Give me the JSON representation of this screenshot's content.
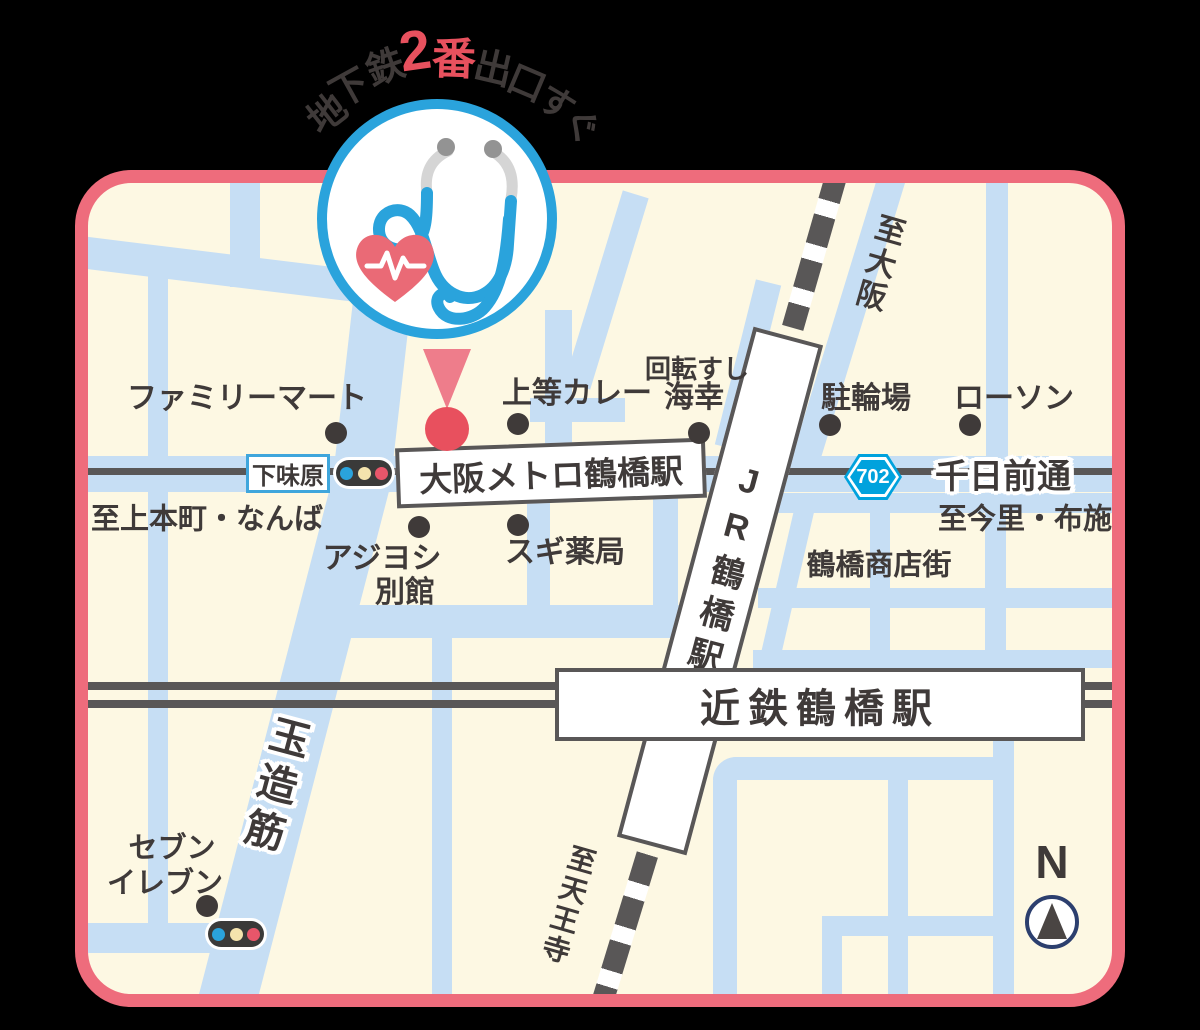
{
  "callout": {
    "arch_text": "地下鉄2番出口すぐ",
    "arch": [
      {
        "ch": "地"
      },
      {
        "ch": "下"
      },
      {
        "ch": "鉄"
      },
      {
        "ch": "2"
      },
      {
        "ch": "番"
      },
      {
        "ch": "出"
      },
      {
        "ch": "口"
      },
      {
        "ch": "す"
      },
      {
        "ch": "ぐ"
      }
    ]
  },
  "stations": {
    "metro": "大阪メトロ鶴橋駅",
    "jr": "JR鶴橋駅",
    "kintetsu": "近鉄鶴橋駅"
  },
  "intersection": {
    "shimoajihara": "下味原"
  },
  "roads": {
    "sennichimae": "千日前通",
    "tamatsukuri": "玉造筋",
    "route_number": "702"
  },
  "directions": {
    "uehommachi": "至上本町・なんば",
    "imazato": "至今里・布施",
    "osaka": "至大阪",
    "tennoji": "至天王寺"
  },
  "landmarks": {
    "familymart": "ファミリーマート",
    "joto_curry": "上等カレー",
    "kaiten_sushi": "回転すし",
    "kaiko": "海幸",
    "bicycle_parking": "駐輪場",
    "lawson": "ローソン",
    "ajiyoshi": "アジヨシ",
    "bekkan": "別館",
    "sugi_pharmacy": "スギ薬局",
    "shotengai": "鶴橋商店街",
    "seven": "セブン",
    "eleven": "イレブン"
  },
  "compass": {
    "label": "N"
  },
  "icons": {
    "logo": "stethoscope-heart-icon",
    "marker": "map-pin-icon",
    "signals": "traffic-light-icon",
    "north": "compass-icon"
  },
  "colors": {
    "accent_blue": "#2aa3dc",
    "accent_red": "#e8515e",
    "frame_pink": "#ee6c7c",
    "road_blue": "#c6def4",
    "map_cream": "#fdf8e3",
    "text_dark": "#3f3a39",
    "rail_gray": "#595757",
    "badge_cyan": "#00a2dd"
  }
}
